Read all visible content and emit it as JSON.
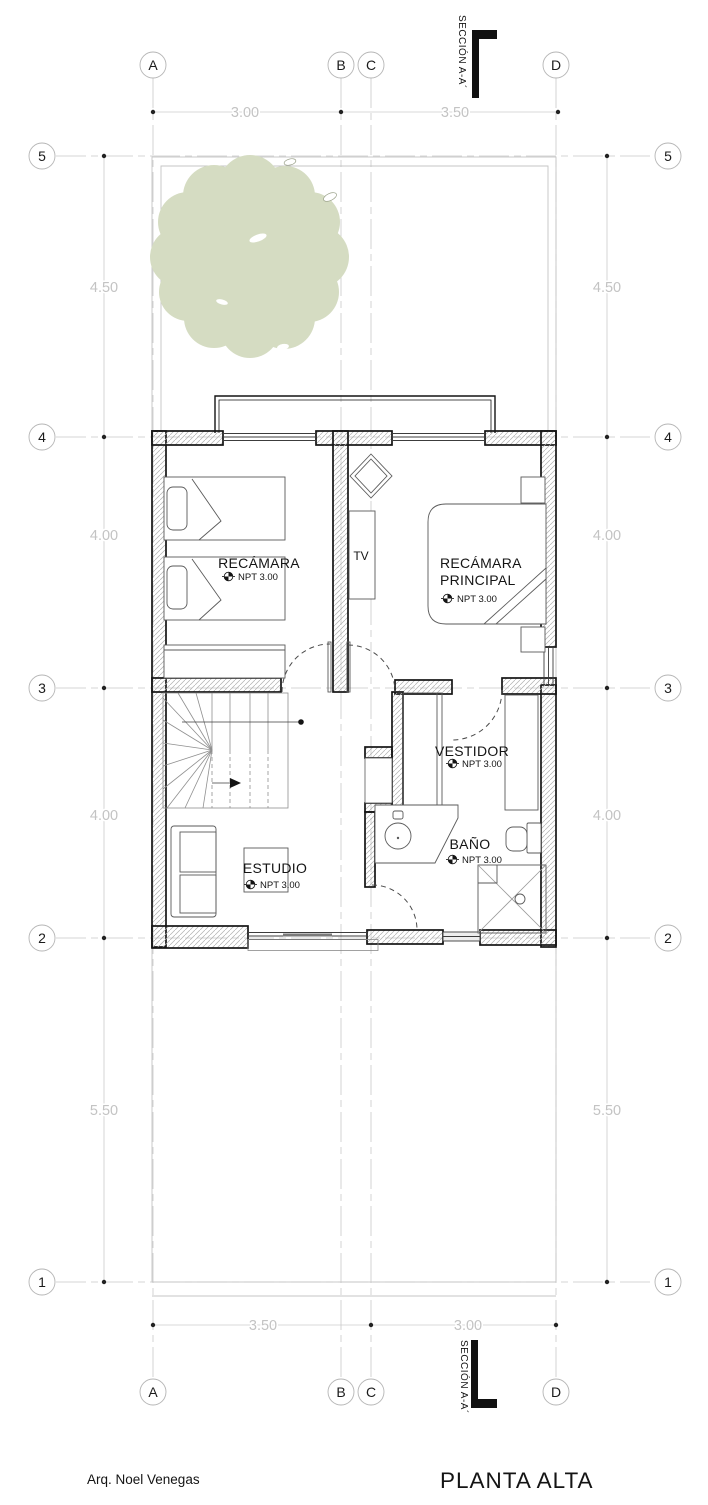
{
  "footer": {
    "author": "Arq. Noel Venegas",
    "title": "PLANTA ALTA"
  },
  "section": {
    "label": "SECCIÓN A-A´"
  },
  "grid": {
    "cols": [
      "A",
      "B",
      "C",
      "D"
    ],
    "rows": [
      "5",
      "4",
      "3",
      "2",
      "1"
    ]
  },
  "dims": {
    "top": [
      "3.00",
      "3.50"
    ],
    "bottom": [
      "3.50",
      "3.00"
    ],
    "side": [
      "4.50",
      "4.00",
      "4.00",
      "5.50"
    ]
  },
  "rooms": {
    "recamara": {
      "name": "RECÁMARA",
      "level": "NPT 3.00"
    },
    "principal": {
      "line1": "RECÁMARA",
      "line2": "PRINCIPAL",
      "level": "NPT 3.00"
    },
    "vestidor": {
      "name": "VESTIDOR",
      "level": "NPT 3.00"
    },
    "bano": {
      "name": "BAÑO",
      "level": "NPT 3.00"
    },
    "estudio": {
      "name": "ESTUDIO",
      "level": "NPT 3.00"
    },
    "tv": {
      "name": "TV"
    }
  },
  "colors": {
    "tree": "#d5dcc2",
    "wall_line": "#141414",
    "grid_line": "#c9c9c9",
    "dim_text": "#c3c3c3"
  }
}
